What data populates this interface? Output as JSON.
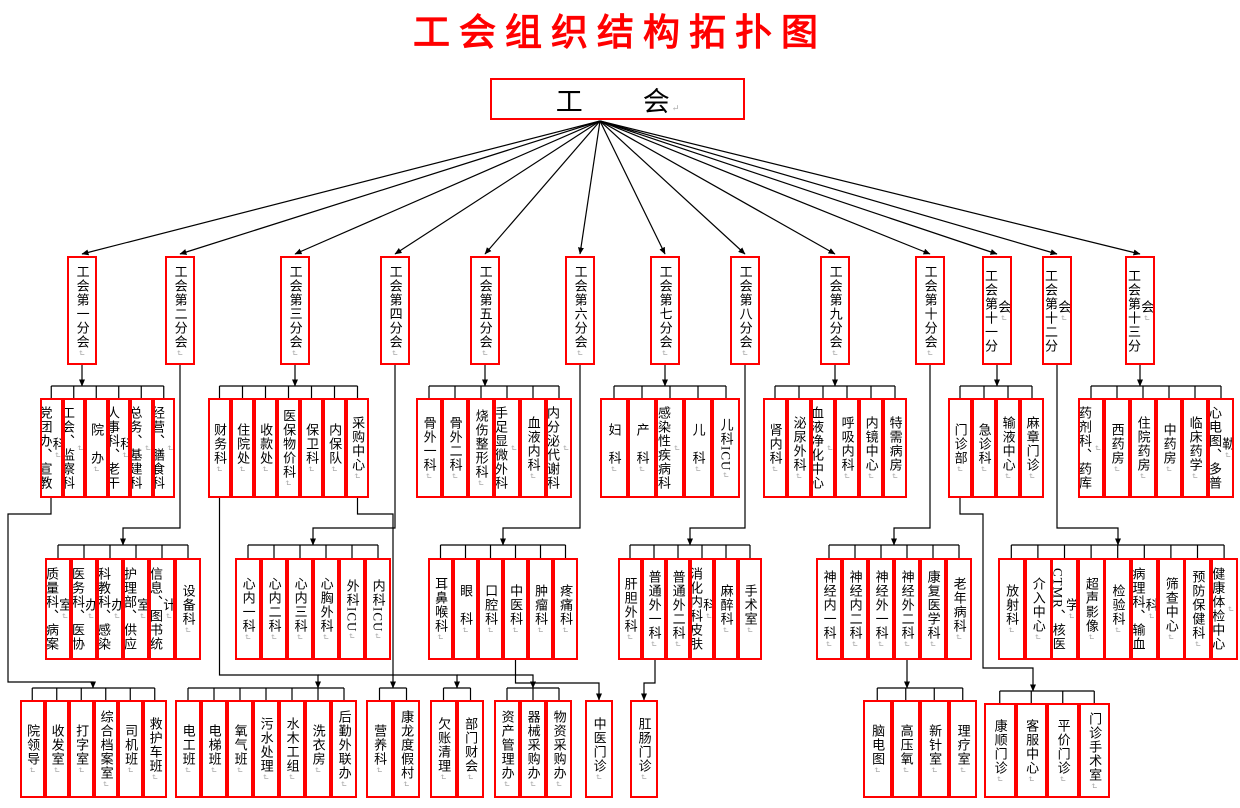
{
  "title": "工会组织结构拓扑图",
  "root": {
    "label": "工　　会"
  },
  "branches": [
    {
      "label": "工会第一分会"
    },
    {
      "label": "工会第二分会"
    },
    {
      "label": "工会第三分会"
    },
    {
      "label": "工会第四分会"
    },
    {
      "label": "工会第五分会"
    },
    {
      "label": "工会第六分会"
    },
    {
      "label": "工会第七分会"
    },
    {
      "label": "工会第八分会"
    },
    {
      "label": "工会第九分会"
    },
    {
      "label": "工会第十分会"
    },
    {
      "label": "工会第十一分会"
    },
    {
      "label": "工会第十二分会"
    },
    {
      "label": "工会第十三分会"
    }
  ],
  "groups": {
    "g1": {
      "items": [
        "党团办、宣教科",
        "工会、监察科",
        "院　办",
        "人事科、老干科",
        "总务、基建科",
        "经营、膳食科"
      ]
    },
    "g2": {
      "items": [
        "质量科、病案室",
        "医务科、医协办",
        "科教科、感染办",
        "护理部、供应室",
        "信息、图书统计",
        "设备科"
      ]
    },
    "g3": {
      "items": [
        "财务科",
        "住院处",
        "收款处",
        "医保物价科",
        "保卫科",
        "内保队",
        "采购中心"
      ]
    },
    "g4": {
      "items": [
        "心内一科",
        "心内二科",
        "心内三科",
        "心胸外科",
        "外科ICU",
        "内科ICU"
      ]
    },
    "g5": {
      "items": [
        "骨外一科",
        "骨外二科",
        "烧伤整形科",
        "手足显微外科",
        "血液内科",
        "内分泌代谢科"
      ]
    },
    "g6": {
      "items": [
        "耳鼻喉科",
        "眼　科",
        "口腔科",
        "中医科",
        "肿瘤科",
        "疼痛科"
      ]
    },
    "g7": {
      "items": [
        "妇　科",
        "产　科",
        "感染性疾病科",
        "儿　科",
        "儿科ICU"
      ]
    },
    "g8": {
      "items": [
        "肝胆外科",
        "普通外一科",
        "普通外二科",
        "消化内科皮肤科",
        "麻醉科",
        "手术室"
      ]
    },
    "g9": {
      "items": [
        "肾内科",
        "泌尿外科",
        "血液净化中心",
        "呼吸内科",
        "内镜中心",
        "特需病房"
      ]
    },
    "g10": {
      "items": [
        "神经内一科",
        "神经内二科",
        "神经外一科",
        "神经外二科",
        "康复医学科",
        "老年病科"
      ]
    },
    "g11": {
      "items": [
        "门诊部",
        "急诊科",
        "输液中心",
        "麻章门诊"
      ]
    },
    "g12": {
      "items": [
        "放射科",
        "介入中心",
        "CTMR、核医学",
        "超声影像",
        "检验科",
        "病理科、输血科",
        "筛查中心",
        "预防保健科",
        "健康体检中心"
      ]
    },
    "g13": {
      "items": [
        "药剂科、药库",
        "西药房",
        "住院药房",
        "中药房",
        "临床药学",
        "心电图、多普勒"
      ]
    },
    "gn": {
      "items": [
        "院领导",
        "收发室",
        "打字室",
        "综合档案室",
        "司机班",
        "救护车班"
      ]
    },
    "go": {
      "items": [
        "电工班",
        "电梯班",
        "氧气班",
        "污水处理",
        "水木工组",
        "洗衣房",
        "后勤外联办"
      ]
    },
    "pair1": {
      "items": [
        "营养科",
        "康龙度假村"
      ]
    },
    "pair2": {
      "items": [
        "欠账清理",
        "部门财会"
      ]
    },
    "triple": {
      "items": [
        "资产管理办",
        "器械采购办",
        "物资采购办"
      ]
    },
    "s1": {
      "items": [
        "中医门诊"
      ]
    },
    "s2": {
      "items": [
        "肛肠门诊"
      ]
    },
    "gp": {
      "items": [
        "脑电图",
        "高压氧",
        "新针室",
        "理疗室"
      ]
    },
    "gq": {
      "items": [
        "康顺门诊",
        "客服中心",
        "平价门诊",
        "门诊手术室"
      ]
    }
  },
  "colors": {
    "box_border": "#ff0000",
    "title_text": "#ff0000",
    "line": "#000000",
    "text": "#000000",
    "paragraph_mark": "#aaaaaa"
  }
}
